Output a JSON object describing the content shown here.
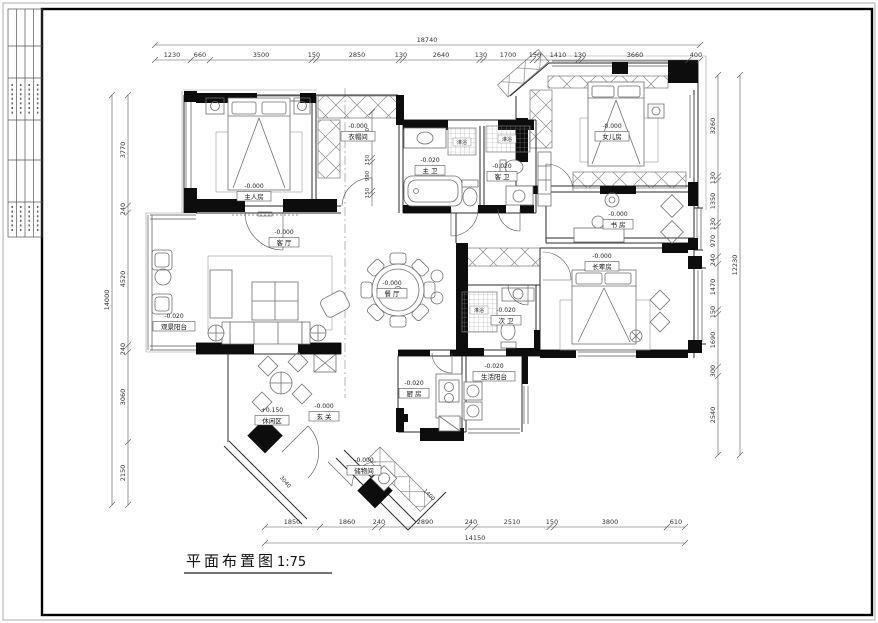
{
  "sheet": {
    "title": "平面布置图",
    "scale": "1:75"
  },
  "dimensions": {
    "top": {
      "total": "18740",
      "segments": [
        "1230",
        "660",
        "3500",
        "150",
        "2850",
        "130",
        "2640",
        "130",
        "1700",
        "150",
        "1410",
        "130",
        "3660",
        "400"
      ]
    },
    "bottom": {
      "total": "14150",
      "segments": [
        "1850",
        "1860",
        "240",
        "2890",
        "240",
        "2510",
        "150",
        "3800",
        "610"
      ]
    },
    "left": {
      "total": "14000",
      "segments": [
        "3770",
        "240",
        "4520",
        "240",
        "3060",
        "2150"
      ]
    },
    "right": {
      "total": "12230",
      "segments": [
        "3260",
        "130",
        "1350",
        "130",
        "970",
        "240",
        "1470",
        "150",
        "1690",
        "300",
        "2540"
      ]
    },
    "closet": {
      "segments": [
        "1560",
        "150",
        "990",
        "150"
      ]
    },
    "diagonal": {
      "left": "3040",
      "right": "1400"
    }
  },
  "rooms": {
    "master": {
      "level": "-0.000",
      "name": "主人房"
    },
    "cloak": {
      "level": "-0.000",
      "name": "衣帽间"
    },
    "bath_master": {
      "level": "-0.020",
      "name": "主 卫"
    },
    "bath_guest": {
      "level": "-0.020",
      "name": "客 卫"
    },
    "daughter": {
      "level": "-0.000",
      "name": "女儿房"
    },
    "study": {
      "level": "-0.000",
      "name": "书 房"
    },
    "elder": {
      "level": "-0.000",
      "name": "长辈房"
    },
    "living": {
      "level": "-0.000",
      "name": "客 厅"
    },
    "dining": {
      "level": "-0.000",
      "name": "餐 厅"
    },
    "kitchen": {
      "level": "-0.020",
      "name": "厨 房"
    },
    "view_balcony": {
      "level": "-0.020",
      "name": "观景阳台"
    },
    "leisure": {
      "level": "+0.150",
      "name": "休闲区"
    },
    "foyer": {
      "level": "-0.000",
      "name": "玄 关"
    },
    "storage": {
      "level": "-0.000",
      "name": "储物间"
    },
    "service_balcony": {
      "level": "-0.020",
      "name": "生活阳台"
    },
    "bath_second": {
      "level": "-0.020",
      "name": "次 卫"
    }
  },
  "fixtures": {
    "shower": "淋浴"
  }
}
